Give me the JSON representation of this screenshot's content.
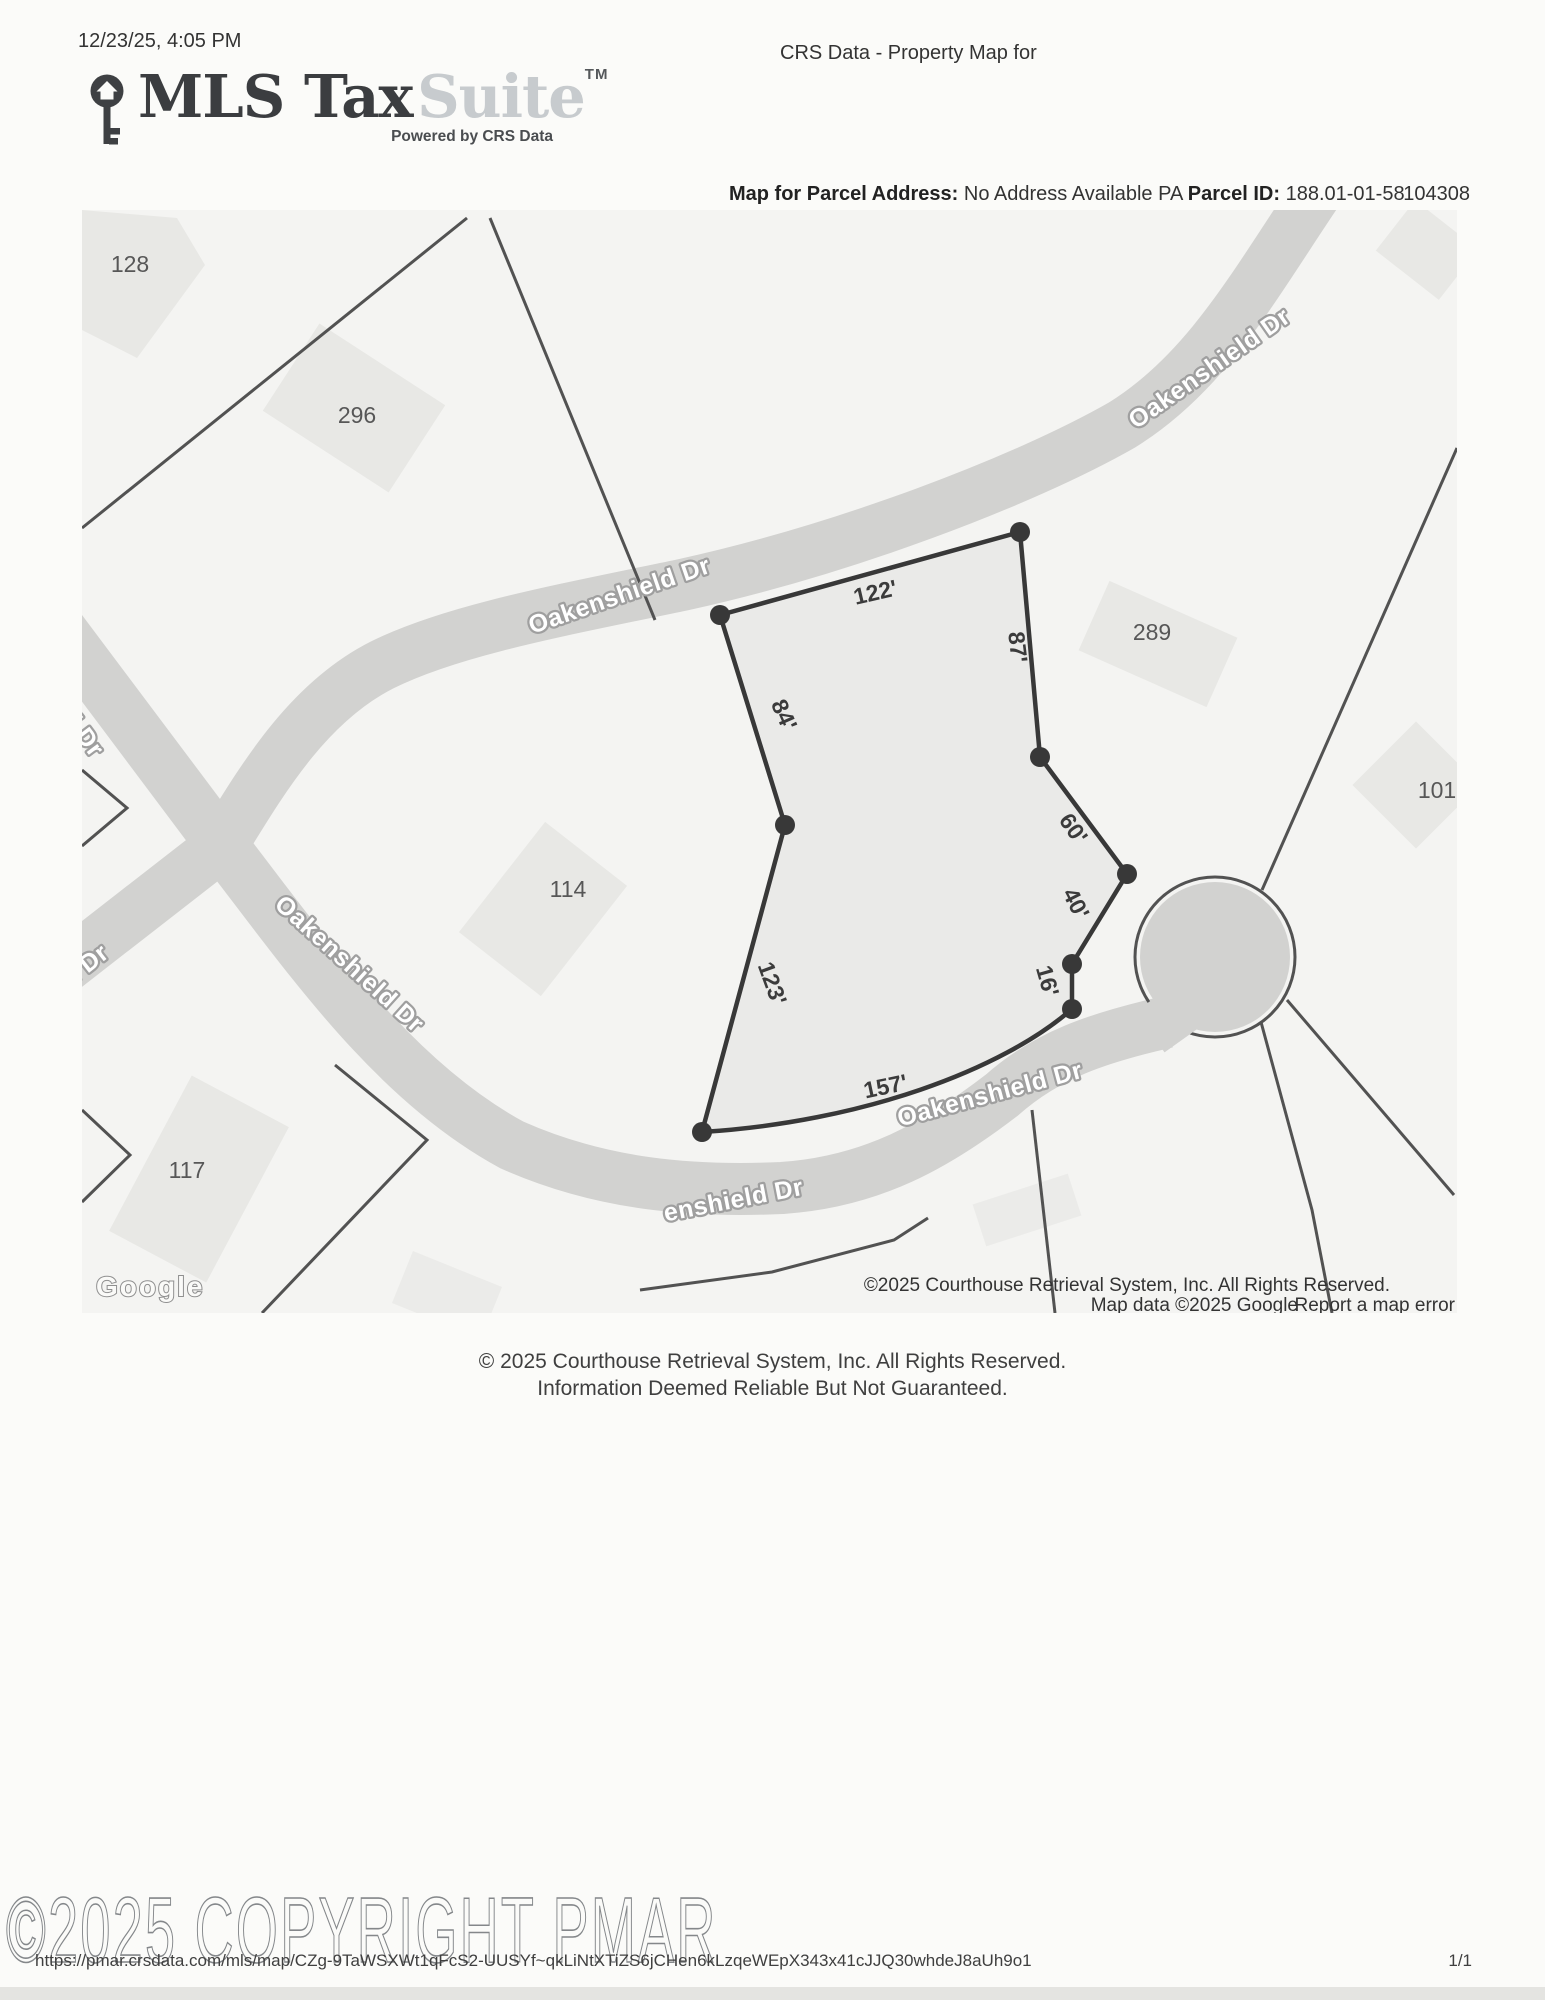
{
  "print_header": {
    "timestamp": "12/23/25, 4:05 PM",
    "title": "CRS Data - Property Map for"
  },
  "branding": {
    "logo_primary": "MLS Tax",
    "logo_secondary": "Suite",
    "trademark": "TM",
    "tagline": "Powered by CRS Data"
  },
  "parcel_info": {
    "address_label": "Map for Parcel Address:",
    "address_value": "No Address Available PA",
    "id_label": "Parcel ID:",
    "id_value": "188.01-01-58",
    "ref": "104308"
  },
  "map": {
    "streets": {
      "top": "Oakenshield Dr",
      "mid": "Oakenshield Dr",
      "diagonal": "Oakenshield Dr",
      "bottom": "Oakenshield Dr",
      "bottom_partial": "enshield Dr",
      "left_upper_partial": "ld Dr",
      "left_lower_partial": "d Dr"
    },
    "parcels": {
      "p128": "128",
      "p296": "296",
      "p289": "289",
      "p101": "101",
      "p114": "114",
      "p117": "117"
    },
    "dims": {
      "d122": "122'",
      "d87": "87'",
      "d84": "84'",
      "d60": "60'",
      "d40": "40'",
      "d16": "16'",
      "d123": "123'",
      "d157": "157'"
    },
    "google": "Google",
    "attribution1": "©2025 Courthouse Retrieval System, Inc. All Rights Reserved.",
    "attribution2": "Map data ©2025 Google",
    "report_link": "Report a map error"
  },
  "disclaimer": {
    "line1": "© 2025 Courthouse Retrieval System, Inc. All Rights Reserved.",
    "line2": "Information Deemed Reliable But Not Guaranteed."
  },
  "watermark": "©2025 COPYRIGHT PMAR",
  "print_footer": {
    "url": "https://pmar.crsdata.com/mls/map/CZg-9TaWSXWt1qFcS2-UUSYf~qkLiNtXTiZS6jCHen6kLzqeWEpX343x41cJJQ30whdeJ8aUh9o1",
    "page": "1/1"
  },
  "colors": {
    "map_background": "#f4f4f2",
    "road": "#d2d2d0",
    "lot_line": "#525252",
    "parcel_outline": "#383838",
    "building": "#e8e8e5"
  }
}
